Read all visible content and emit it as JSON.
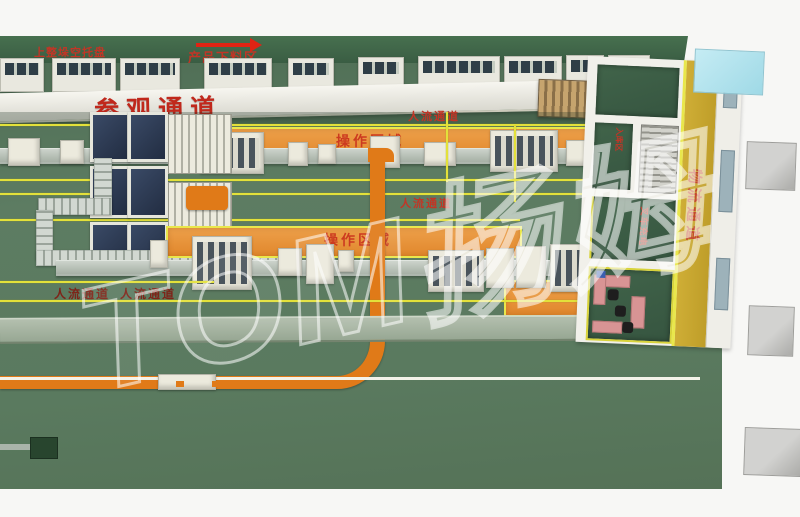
{
  "scene": "factory-floor-plan-3d-top-view",
  "watermark": "TOM扬姆",
  "labels": {
    "empty_tray_loading": "上整垛空托盘",
    "product_unloading_area": "产品下料区",
    "visiting_corridor": "参观通道",
    "people_corridor_top": "人流通道",
    "people_corridor_middle": "人流通道",
    "people_corridor_bottom_1": "人流通道",
    "people_corridor_bottom_2": "人流通道",
    "operation_area_top": "操作区域",
    "operation_area_middle": "操作区域",
    "logistics_corridor": "物流通道",
    "forklift_charging": "叉车充电",
    "warehouse_entry": "入库区"
  },
  "icons": {
    "flow_arrow": "arrow-right"
  },
  "colors": {
    "floor_green": "#5b7a60",
    "top_bar_green": "#3e6449",
    "operation_orange": "#e8933c",
    "conveyor_orange": "#e07a18",
    "lane_yellow": "#e3e13a",
    "logistics_yellow": "#c7a62e",
    "label_red": "#c0281c",
    "label_dark_red": "#7e2418",
    "walkway_white": "#f2f1ea",
    "walkway_gray_green": "#a3b1a0",
    "dock_gray": "#c0c0bf",
    "glass_cyan": "#b5e6ef",
    "machine_panel_blue": "#2e3a52"
  }
}
